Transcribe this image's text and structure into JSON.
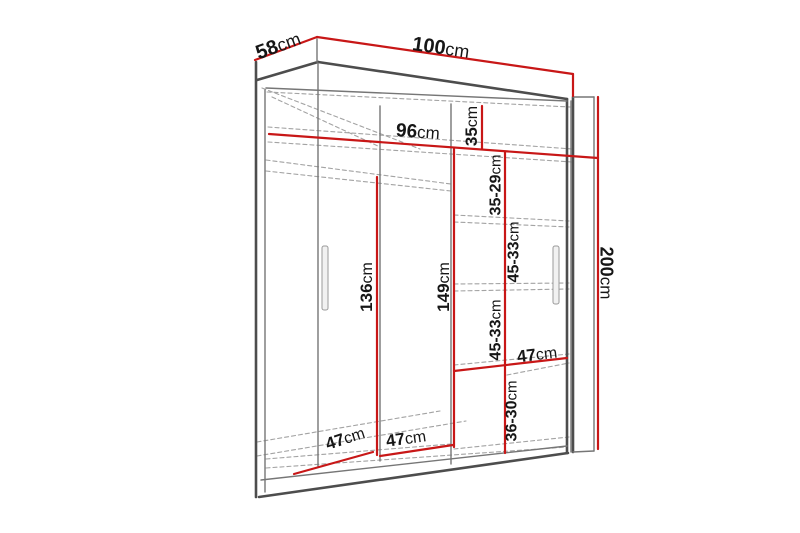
{
  "diagram": {
    "name": "wardrobe-dimension-diagram",
    "background": "#ffffff",
    "colors": {
      "dimension_red": "#c81717",
      "edge_dark": "#4d4d4d",
      "edge_mid": "#767676",
      "edge_dash": "#a3a3a3",
      "text": "#161616",
      "handle_fill": "#f1f1f1",
      "handle_stroke": "#9a9a9a"
    },
    "labels": [
      {
        "id": "depth-top",
        "value": "58",
        "unit": "cm",
        "x": 278,
        "y": 45,
        "rotate": -20,
        "size": 20
      },
      {
        "id": "width-top",
        "value": "100",
        "unit": "cm",
        "x": 441,
        "y": 47,
        "rotate": 8,
        "size": 20
      },
      {
        "id": "interior-width",
        "value": "96",
        "unit": "cm",
        "x": 418,
        "y": 131,
        "rotate": 4,
        "size": 19
      },
      {
        "id": "height-right",
        "value": "200",
        "unit": "cm",
        "x": 607,
        "y": 273,
        "rotate": 90,
        "size": 18
      },
      {
        "id": "top-shelf-height",
        "value": "35",
        "unit": "cm",
        "x": 471,
        "y": 126,
        "rotate": -90,
        "size": 17
      },
      {
        "id": "section-1",
        "value": "35-29",
        "unit": "cm",
        "x": 495,
        "y": 185,
        "rotate": -90,
        "size": 16
      },
      {
        "id": "section-2",
        "value": "45-33",
        "unit": "cm",
        "x": 513,
        "y": 252,
        "rotate": -90,
        "size": 16
      },
      {
        "id": "section-3",
        "value": "45-33",
        "unit": "cm",
        "x": 495,
        "y": 330,
        "rotate": -90,
        "size": 16
      },
      {
        "id": "section-4",
        "value": "36-30",
        "unit": "cm",
        "x": 511,
        "y": 411,
        "rotate": -90,
        "size": 16
      },
      {
        "id": "hanging-height",
        "value": "136",
        "unit": "cm",
        "x": 366,
        "y": 287,
        "rotate": -90,
        "size": 17
      },
      {
        "id": "shelf-column",
        "value": "149",
        "unit": "cm",
        "x": 443,
        "y": 287,
        "rotate": -90,
        "size": 17
      },
      {
        "id": "shelf-width",
        "value": "47",
        "unit": "cm",
        "x": 537,
        "y": 354,
        "rotate": -7,
        "size": 17
      },
      {
        "id": "left-width",
        "value": "47",
        "unit": "cm",
        "x": 406,
        "y": 438,
        "rotate": -8,
        "size": 17
      },
      {
        "id": "left-depth",
        "value": "47",
        "unit": "cm",
        "x": 345,
        "y": 438,
        "rotate": -18,
        "size": 17
      }
    ],
    "red_lines": [
      {
        "id": "dim-58",
        "x1": 255,
        "y1": 60,
        "x2": 317,
        "y2": 37
      },
      {
        "id": "dim-100",
        "x1": 317,
        "y1": 37,
        "x2": 573,
        "y2": 74
      },
      {
        "id": "dim-100-drop",
        "x1": 573,
        "y1": 74,
        "x2": 573,
        "y2": 96
      },
      {
        "id": "dim-200",
        "x1": 598,
        "y1": 97,
        "x2": 598,
        "y2": 449
      },
      {
        "id": "dim-96",
        "x1": 269,
        "y1": 134,
        "x2": 598,
        "y2": 158
      },
      {
        "id": "dim-35",
        "x1": 482,
        "y1": 106,
        "x2": 482,
        "y2": 149
      },
      {
        "id": "dim-sections",
        "x1": 505,
        "y1": 152,
        "x2": 505,
        "y2": 453
      },
      {
        "id": "dim-149",
        "x1": 454,
        "y1": 149,
        "x2": 454,
        "y2": 447
      },
      {
        "id": "dim-136",
        "x1": 377,
        "y1": 177,
        "x2": 377,
        "y2": 455
      },
      {
        "id": "dim-47-right",
        "x1": 454,
        "y1": 371,
        "x2": 567,
        "y2": 358
      },
      {
        "id": "dim-47-center",
        "x1": 380,
        "y1": 456,
        "x2": 453,
        "y2": 445
      },
      {
        "id": "dim-47-left",
        "x1": 294,
        "y1": 474,
        "x2": 373,
        "y2": 452
      }
    ],
    "solid_lines": [
      {
        "id": "top-front-edge",
        "kind": "thick",
        "x1": 318,
        "y1": 62,
        "x2": 567,
        "y2": 99
      },
      {
        "id": "top-slab-left",
        "kind": "thick",
        "x1": 257,
        "y1": 80,
        "x2": 318,
        "y2": 62
      },
      {
        "id": "left-front-edge",
        "kind": "thick",
        "x1": 256,
        "y1": 62,
        "x2": 256,
        "y2": 497
      },
      {
        "id": "bottom-edge",
        "kind": "thick",
        "x1": 259,
        "y1": 497,
        "x2": 568,
        "y2": 453
      },
      {
        "id": "right-front-edge",
        "kind": "thick",
        "x1": 567,
        "y1": 99,
        "x2": 567,
        "y2": 453
      },
      {
        "id": "side-panel-inner",
        "kind": "thick",
        "x1": 573,
        "y1": 97,
        "x2": 573,
        "y2": 452
      },
      {
        "id": "slab-corner",
        "kind": "mid",
        "x1": 317,
        "y1": 39,
        "x2": 317,
        "y2": 62
      },
      {
        "id": "left-inner-edge",
        "kind": "mid",
        "x1": 265,
        "y1": 90,
        "x2": 265,
        "y2": 492
      },
      {
        "id": "top-inner-edge",
        "kind": "mid",
        "x1": 266,
        "y1": 88,
        "x2": 567,
        "y2": 101
      },
      {
        "id": "door-edge-left",
        "kind": "mid",
        "x1": 318,
        "y1": 63,
        "x2": 318,
        "y2": 466
      },
      {
        "id": "divider-center",
        "kind": "mid",
        "x1": 380,
        "y1": 106,
        "x2": 380,
        "y2": 461
      },
      {
        "id": "divider-right",
        "kind": "mid",
        "x1": 451,
        "y1": 104,
        "x2": 451,
        "y2": 464
      },
      {
        "id": "right-inner-edge",
        "kind": "mid",
        "x1": 571,
        "y1": 101,
        "x2": 571,
        "y2": 452
      },
      {
        "id": "side-panel-outer",
        "kind": "mid",
        "x1": 594,
        "y1": 97,
        "x2": 594,
        "y2": 451
      },
      {
        "id": "side-panel-top",
        "kind": "mid",
        "x1": 573,
        "y1": 97,
        "x2": 594,
        "y2": 97
      },
      {
        "id": "side-panel-bottom",
        "kind": "mid",
        "x1": 573,
        "y1": 452,
        "x2": 594,
        "y2": 451
      },
      {
        "id": "plinth-top-edge",
        "kind": "mid",
        "x1": 261,
        "y1": 480,
        "x2": 567,
        "y2": 446
      }
    ],
    "dashed_lines": [
      {
        "id": "top-back-edge",
        "x1": 267,
        "y1": 92,
        "x2": 570,
        "y2": 107
      },
      {
        "id": "top-depth-diag-1",
        "x1": 262,
        "y1": 88,
        "x2": 420,
        "y2": 149
      },
      {
        "id": "top-depth-diag-2",
        "x1": 272,
        "y1": 97,
        "x2": 380,
        "y2": 147
      },
      {
        "id": "top-shelf-front",
        "x1": 268,
        "y1": 127,
        "x2": 572,
        "y2": 149
      },
      {
        "id": "top-shelf-back",
        "x1": 268,
        "y1": 142,
        "x2": 572,
        "y2": 162
      },
      {
        "id": "rail-front",
        "x1": 266,
        "y1": 160,
        "x2": 451,
        "y2": 184
      },
      {
        "id": "rail-back",
        "x1": 266,
        "y1": 171,
        "x2": 451,
        "y2": 191
      },
      {
        "id": "shelf-1-front",
        "x1": 454,
        "y1": 215,
        "x2": 569,
        "y2": 221
      },
      {
        "id": "shelf-1-back",
        "x1": 454,
        "y1": 222,
        "x2": 569,
        "y2": 227
      },
      {
        "id": "shelf-2-front",
        "x1": 454,
        "y1": 284,
        "x2": 569,
        "y2": 283
      },
      {
        "id": "shelf-2-back",
        "x1": 454,
        "y1": 291,
        "x2": 569,
        "y2": 289
      },
      {
        "id": "shelf-3-front",
        "x1": 454,
        "y1": 365,
        "x2": 569,
        "y2": 354
      },
      {
        "id": "shelf-3-back",
        "x1": 507,
        "y1": 375,
        "x2": 569,
        "y2": 363
      },
      {
        "id": "shelf-4-front",
        "x1": 454,
        "y1": 449,
        "x2": 569,
        "y2": 437
      },
      {
        "id": "floor-front",
        "x1": 266,
        "y1": 468,
        "x2": 567,
        "y2": 447
      },
      {
        "id": "floor-inner-left",
        "x1": 266,
        "y1": 459,
        "x2": 451,
        "y2": 444
      },
      {
        "id": "floor-depth-diag-1",
        "x1": 257,
        "y1": 442,
        "x2": 440,
        "y2": 411
      },
      {
        "id": "floor-depth-diag-2",
        "x1": 257,
        "y1": 456,
        "x2": 466,
        "y2": 421
      }
    ],
    "handles": [
      {
        "id": "left-door-handle",
        "x": 322,
        "y": 246,
        "w": 6,
        "h": 64
      },
      {
        "id": "right-door-handle",
        "x": 553,
        "y": 246,
        "w": 6,
        "h": 58
      }
    ]
  }
}
